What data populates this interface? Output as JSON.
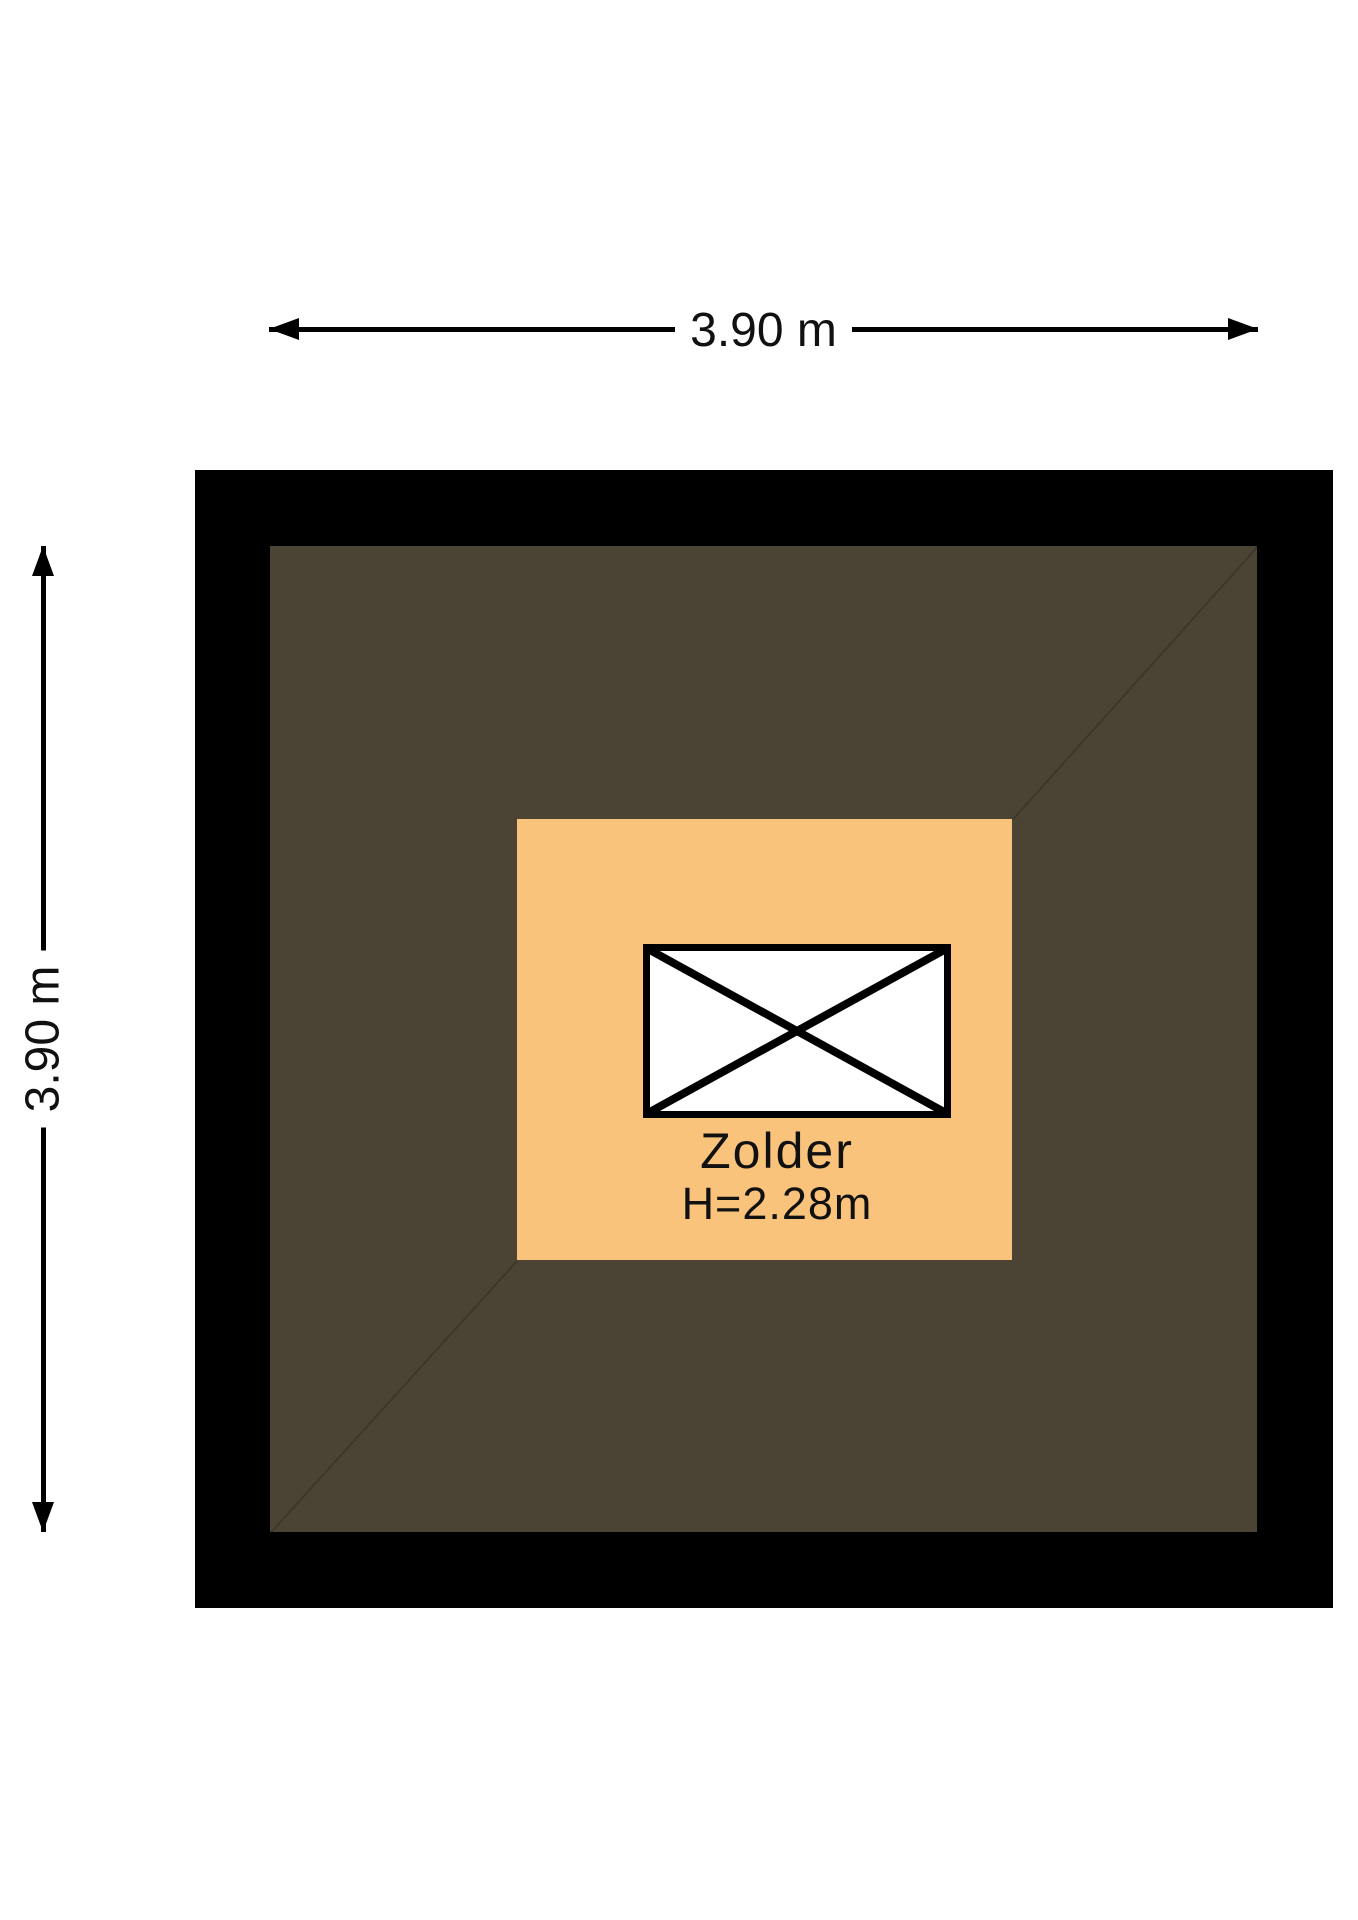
{
  "floorplan": {
    "dimension_top": {
      "label": "3.90 m"
    },
    "dimension_left": {
      "label": "3.90 m"
    },
    "room": {
      "name": "Zolder",
      "ceiling_height": "H=2.28m"
    },
    "icons": {
      "stair_opening": "crossed-box-opening-icon"
    },
    "colors": {
      "wall": "#000000",
      "roof_area": "#4B4334",
      "room_fill": "#F9C37B",
      "opening_fill": "#FFFFFF",
      "line_and_text": "#111111"
    }
  }
}
